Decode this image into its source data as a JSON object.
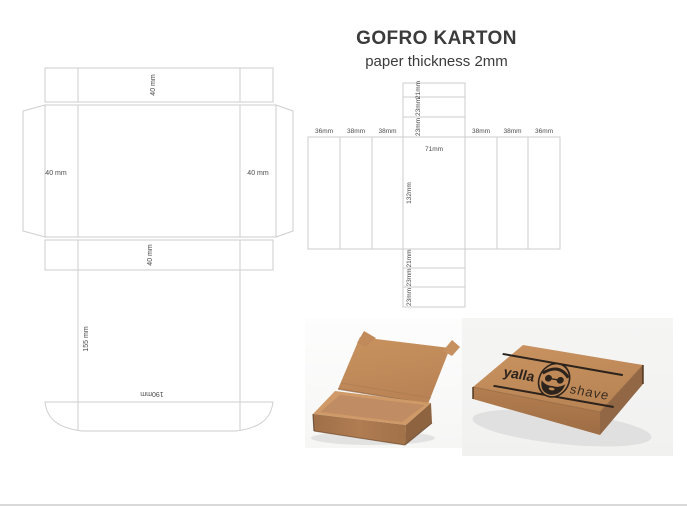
{
  "header": {
    "title": "GOFRO KARTON",
    "subtitle": "paper thickness 2mm"
  },
  "lid_template": {
    "top_flap": "40 mm",
    "left_flap": "40 mm",
    "right_flap": "40 mm",
    "bottom_flap": "40 mm",
    "panel_height": "155 mm",
    "panel_width": "190mm"
  },
  "body_template": {
    "columns_left": [
      "36mm",
      "38mm",
      "38mm"
    ],
    "columns_right": [
      "38mm",
      "38mm",
      "36mm"
    ],
    "center_width": "71mm",
    "center_height": "132mm",
    "top_cells": [
      "21mm",
      "23mm",
      "23mm"
    ],
    "bottom_cells": [
      "21mm",
      "23mm",
      "23mm"
    ]
  },
  "product": {
    "brand_bold": "yalla",
    "brand_light": "shave"
  },
  "colors": {
    "kraft": "#c08a58",
    "logo_ink": "#2c231d",
    "template_line": "#cecece",
    "dim_text": "#4b4b4b"
  }
}
